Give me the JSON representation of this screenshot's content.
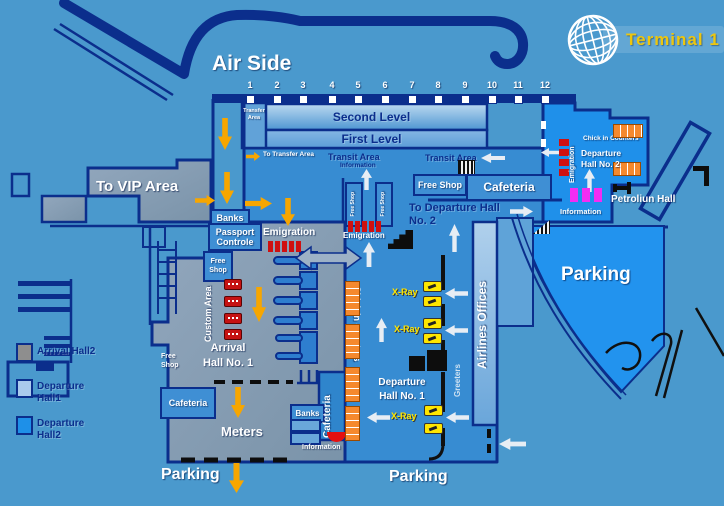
{
  "branding": {
    "terminal_label": "Terminal 1",
    "airside_label": "Air Side"
  },
  "gates": [
    "1",
    "2",
    "3",
    "4",
    "5",
    "6",
    "7",
    "8",
    "9",
    "10",
    "11",
    "12"
  ],
  "levels": {
    "second": "Second Level",
    "first": "First Level",
    "transfer_l1": "Transfer",
    "transfer_l2": "Area"
  },
  "labels": {
    "to_transfer_area": "To Transfer Area",
    "transit_area": "Transit Area",
    "information": "Information",
    "free_shop": "Free Shop",
    "free_shop_l1": "Free",
    "free_shop_l2": "Shop",
    "cafeteria": "Cafeteria",
    "to_departure_hall_l1": "To Departure Hall",
    "to_departure_hall_l2": "No. 2",
    "to_vip_area": "To VIP Area",
    "banks": "Banks",
    "passport_l1": "Passport",
    "passport_l2": "Controle",
    "emigration": "Emigration",
    "custom_area": "Custom Area",
    "arrival_hall_l1": "Arrival",
    "arrival_hall_l2": "Hall No. 1",
    "meters": "Meters",
    "parking": "Parking",
    "chick_in_counters": "Chick in counters",
    "chick_in_counters_title": "Chick in Counters",
    "x_ray": "X-Ray",
    "airlines_offices": "Airlines Offices",
    "greeters": "Greeters",
    "departure_l1": "Departure",
    "departure_hall1_l2": "Hall No. 1",
    "departure_hall2_l2": "Hall No. 2",
    "petroliun_hall": "Petroliun Hall"
  },
  "legend": [
    {
      "l1": "Arrival Hall2",
      "color": "#8e8e8e"
    },
    {
      "l1": "Departure",
      "l2": "Hall1",
      "color": "#aacbec"
    },
    {
      "l1": "Departure",
      "l2": "Hall2",
      "color": "#1e90e8"
    }
  ],
  "colors": {
    "background": "#4a99cd",
    "wall_navy": "#0b2e8c",
    "hall_gray": "#8297b0",
    "hall_blue": "#378cd2",
    "bright_blue": "#1f90ea",
    "parking_blue": "#2293ee",
    "orange_arrow": "#f7a600",
    "white_arrow": "#e7edf4",
    "seat_red": "#cf1010",
    "seat_magenta": "#f32cf3",
    "counter_orange": "#f5892e",
    "xray_yellow": "#ffe600",
    "terminal_gold": "#edc60e"
  }
}
